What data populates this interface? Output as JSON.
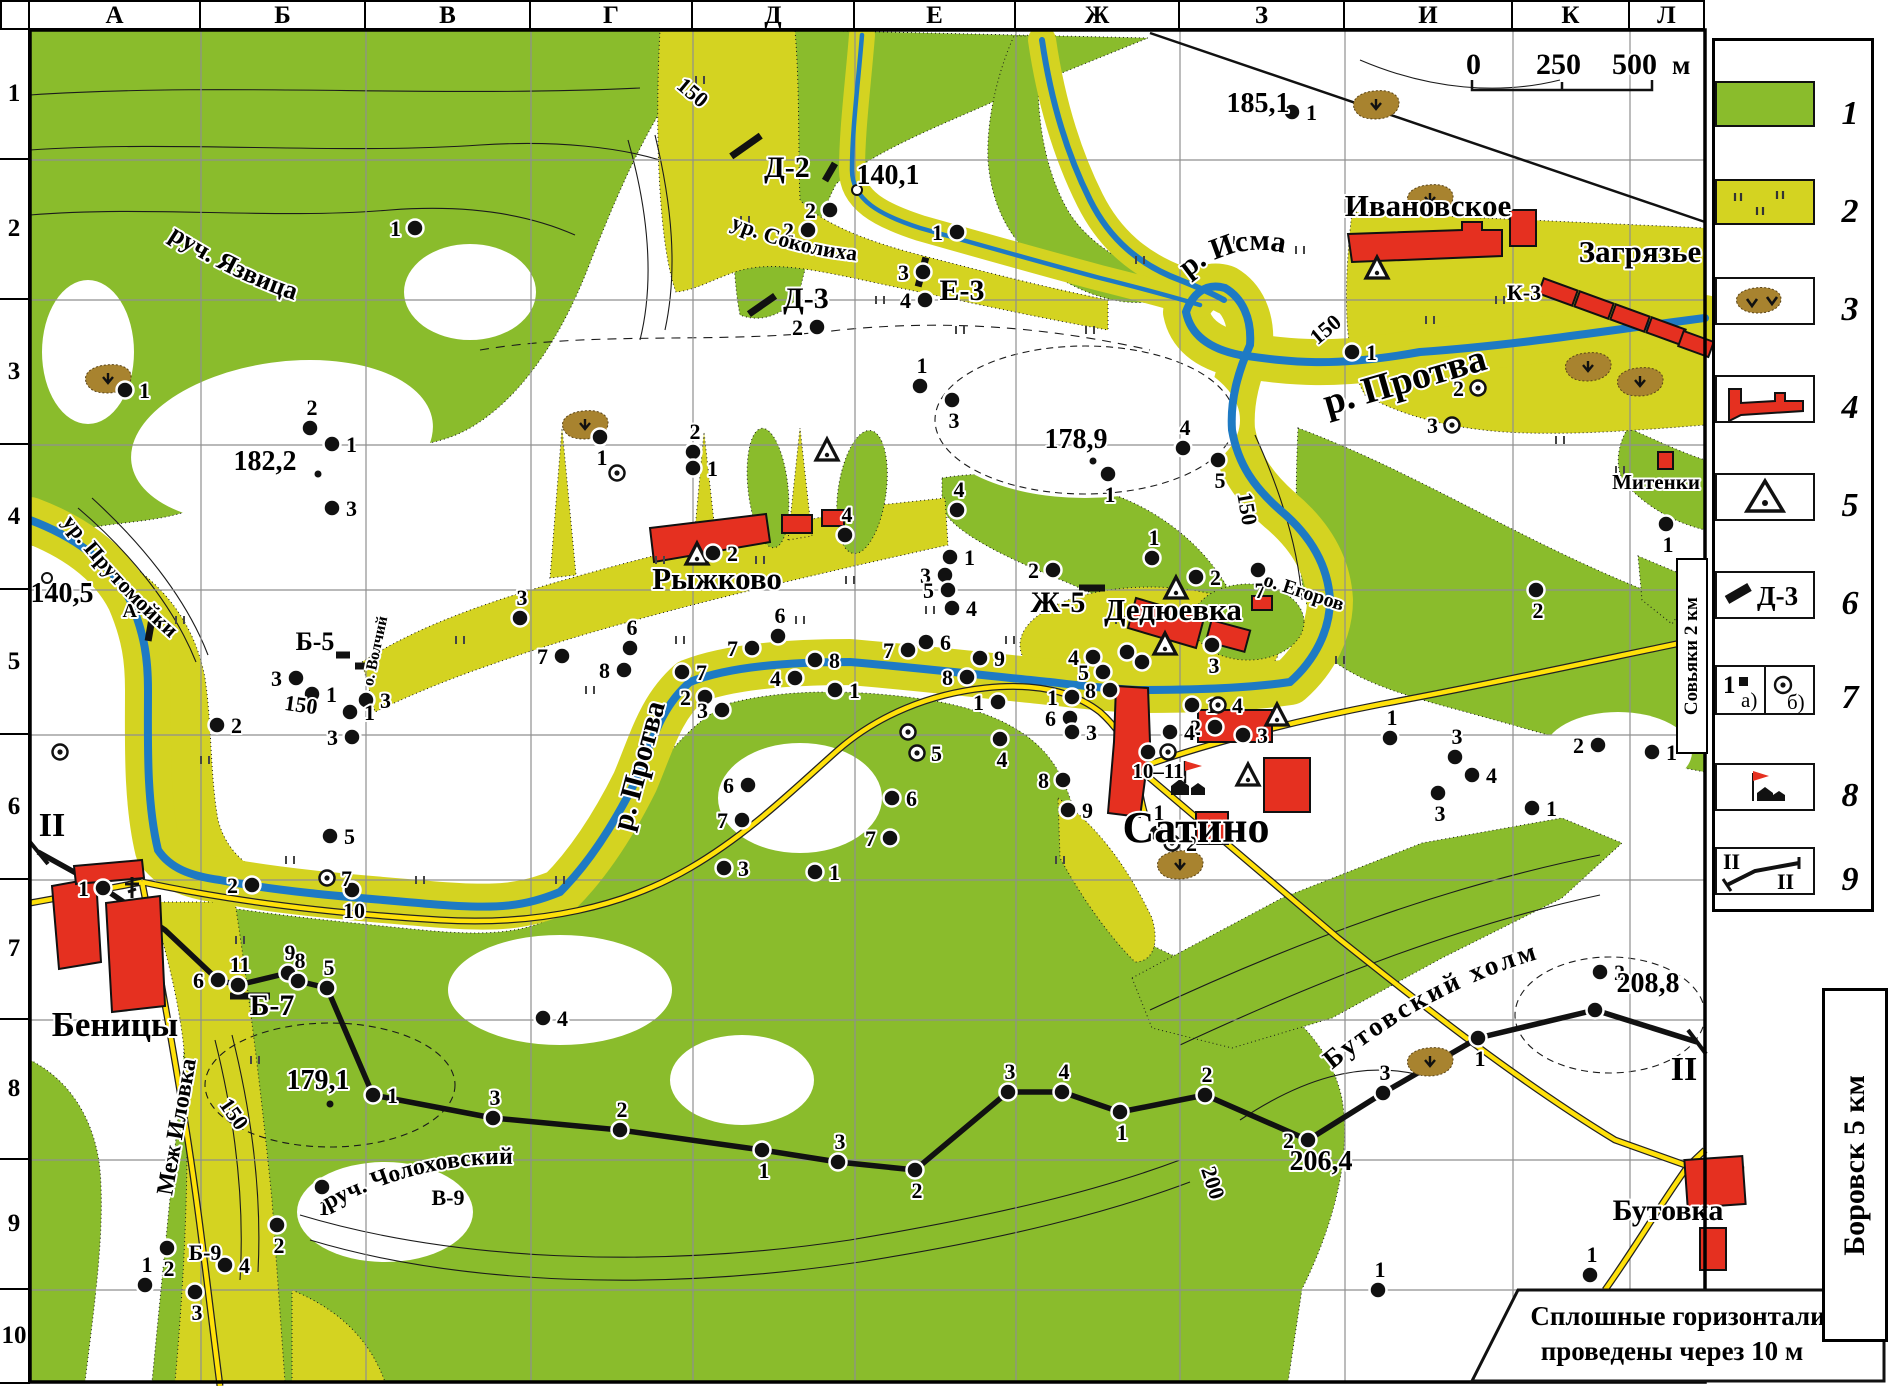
{
  "grid": {
    "columns": [
      "А",
      "Б",
      "В",
      "Г",
      "Д",
      "Е",
      "Ж",
      "З",
      "И",
      "К",
      "Л"
    ],
    "rows": [
      "1",
      "2",
      "3",
      "4",
      "5",
      "6",
      "7",
      "8",
      "9",
      "10"
    ]
  },
  "scalebar": {
    "t0": "0",
    "t1": "250",
    "t2": "500",
    "unit": "м"
  },
  "note": {
    "l1": "Сплошные  горизонтали",
    "l2": "проведены  через  10 м"
  },
  "edge": {
    "sovyaki": "Совьяки  2 км",
    "borovsk": "Боровск  5 км"
  },
  "legend": {
    "nums": [
      "1",
      "2",
      "3",
      "4",
      "5",
      "6",
      "7",
      "8",
      "9"
    ],
    "d3": "Д-3",
    "a": "а)",
    "b": "б)",
    "one": "1",
    "ii": "II"
  },
  "colors": {
    "forest": "#8abc2c",
    "meadow": "#d4d321",
    "water": "#1e7ac4",
    "road": "#ffe10a",
    "settlement": "#e53020",
    "pit": "#a8832f"
  },
  "map": {
    "settlements": [
      [
        "Ивановское",
        1428,
        216,
        31
      ],
      [
        "Загрязье",
        1640,
        262,
        31
      ],
      [
        "Митенки",
        1656,
        489,
        21
      ],
      [
        "Рыжково",
        717,
        589,
        31
      ],
      [
        "Дедюевка",
        1173,
        620,
        31
      ],
      [
        "Сатино",
        1196,
        842,
        44
      ],
      [
        "Беницы",
        115,
        1036,
        35
      ],
      [
        "Бутовка",
        1668,
        1220,
        30
      ]
    ],
    "elevations": [
      [
        "185,1",
        1258,
        112
      ],
      [
        "140,1",
        888,
        184
      ],
      [
        "182,2",
        265,
        470
      ],
      [
        "178,9",
        1076,
        448
      ],
      [
        "140,5",
        62,
        602
      ],
      [
        "179,1",
        318,
        1089
      ],
      [
        "208,8",
        1648,
        992
      ],
      [
        "206,4",
        1321,
        1170
      ]
    ],
    "contours": [
      [
        "150",
        688,
        98,
        40
      ],
      [
        "150",
        1330,
        335,
        -40
      ],
      [
        "150",
        1240,
        510,
        80
      ],
      [
        "150",
        300,
        712,
        8
      ],
      [
        "150",
        228,
        1118,
        55
      ],
      [
        "200",
        1206,
        1185,
        72
      ]
    ],
    "codes": [
      [
        "Д-2",
        787,
        177,
        30
      ],
      [
        "Д-3",
        806,
        308,
        30
      ],
      [
        "Е-3",
        962,
        300,
        30
      ],
      [
        "К-3",
        1524,
        300,
        22
      ],
      [
        "А-5",
        138,
        617,
        20
      ],
      [
        "Б-5",
        315,
        650,
        26
      ],
      [
        "Ж-5",
        1058,
        612,
        30
      ],
      [
        "Б-7",
        272,
        1015,
        30
      ],
      [
        "Б-9",
        205,
        1260,
        22
      ],
      [
        "В-9",
        448,
        1205,
        22
      ]
    ],
    "arcs": {
      "yazvitsa": "руч. Язвица",
      "sokoliha": "ур. Соколиха",
      "isma": "р. Исма",
      "prutomoyki": "ур. Прутомойки",
      "cholohovsky": "руч. Чолоховский",
      "butovsky": "Бутовский  холм"
    },
    "waters": [
      [
        "р. Протва",
        648,
        768,
        -75,
        30
      ],
      [
        "р. Протва",
        1408,
        392,
        -16,
        38
      ],
      [
        "о. Волчий",
        380,
        652,
        -78,
        16
      ],
      [
        "о. Егоров",
        1302,
        598,
        18,
        20
      ],
      [
        "Меж Иловка",
        184,
        1128,
        -80,
        24
      ]
    ],
    "plain": [
      [
        "10–11",
        1158,
        778,
        21
      ]
    ],
    "dots": [
      [
        415,
        228,
        "1",
        "l"
      ],
      [
        830,
        210,
        "2",
        "l"
      ],
      [
        808,
        230,
        "2",
        "l"
      ],
      [
        957,
        232,
        "1",
        "l"
      ],
      [
        923,
        272,
        "3",
        "l"
      ],
      [
        925,
        300,
        "4",
        "l"
      ],
      [
        817,
        327,
        "2",
        "l"
      ],
      [
        1292,
        112,
        "1",
        "r"
      ],
      [
        125,
        390,
        "1",
        "r"
      ],
      [
        310,
        428,
        "2",
        "a"
      ],
      [
        332,
        444,
        "1",
        "r"
      ],
      [
        332,
        508,
        "3",
        "r"
      ],
      [
        1352,
        352,
        "1",
        "r"
      ],
      [
        1666,
        524,
        "1",
        "b"
      ],
      [
        600,
        437,
        "1",
        "b"
      ],
      [
        693,
        452,
        "2",
        "a"
      ],
      [
        693,
        468,
        "1",
        "r"
      ],
      [
        920,
        386,
        "1",
        "a"
      ],
      [
        952,
        400,
        "3",
        "b"
      ],
      [
        957,
        510,
        "4",
        "a"
      ],
      [
        1183,
        448,
        "4",
        "a"
      ],
      [
        1218,
        460,
        "5",
        "b"
      ],
      [
        1108,
        474,
        "1",
        "b"
      ],
      [
        713,
        553,
        "2",
        "r"
      ],
      [
        845,
        535,
        "4",
        "a"
      ],
      [
        950,
        557,
        "1",
        "r"
      ],
      [
        945,
        575,
        "3",
        "l"
      ],
      [
        948,
        590,
        "5",
        "l"
      ],
      [
        952,
        608,
        "4",
        "r"
      ],
      [
        1053,
        570,
        "2",
        "l"
      ],
      [
        1152,
        558,
        "1",
        "a"
      ],
      [
        1196,
        577,
        "2",
        "r"
      ],
      [
        1212,
        645,
        "3",
        "b"
      ],
      [
        1258,
        570,
        "7",
        "b"
      ],
      [
        1536,
        590,
        "2",
        "b"
      ],
      [
        296,
        678,
        "3",
        "l"
      ],
      [
        312,
        694,
        "1",
        "r"
      ],
      [
        366,
        700,
        "3",
        "r"
      ],
      [
        520,
        618,
        "3",
        "a"
      ],
      [
        562,
        656,
        "7",
        "l"
      ],
      [
        630,
        648,
        "6",
        "a"
      ],
      [
        624,
        670,
        "8",
        "l"
      ],
      [
        682,
        672,
        "7",
        "r"
      ],
      [
        752,
        648,
        "7",
        "l"
      ],
      [
        778,
        636,
        "6",
        "a"
      ],
      [
        815,
        660,
        "8",
        "r"
      ],
      [
        795,
        678,
        "4",
        "l"
      ],
      [
        835,
        690,
        "1",
        "r"
      ],
      [
        705,
        697,
        "2",
        "l"
      ],
      [
        722,
        710,
        "3",
        "l"
      ],
      [
        748,
        785,
        "6",
        "l"
      ],
      [
        742,
        820,
        "7",
        "l"
      ],
      [
        724,
        868,
        "3",
        "r"
      ],
      [
        815,
        872,
        "1",
        "r"
      ],
      [
        908,
        650,
        "7",
        "l"
      ],
      [
        926,
        642,
        "6",
        "r"
      ],
      [
        980,
        658,
        "9",
        "r"
      ],
      [
        967,
        677,
        "8",
        "l"
      ],
      [
        892,
        798,
        "6",
        "r"
      ],
      [
        890,
        838,
        "7",
        "l"
      ],
      [
        1093,
        657,
        "4",
        "l"
      ],
      [
        1103,
        672,
        "5",
        "l"
      ],
      [
        1110,
        690,
        "8",
        "l"
      ],
      [
        1127,
        652,
        "",
        ""
      ],
      [
        1142,
        662,
        "",
        ""
      ],
      [
        998,
        702,
        "1",
        "l"
      ],
      [
        1072,
        697,
        "1",
        "l"
      ],
      [
        1070,
        718,
        "6",
        "l"
      ],
      [
        1072,
        732,
        "3",
        "r"
      ],
      [
        1000,
        739,
        "4",
        "b"
      ],
      [
        1063,
        780,
        "8",
        "l"
      ],
      [
        1068,
        810,
        "9",
        "r"
      ],
      [
        1148,
        752,
        "",
        ""
      ],
      [
        1192,
        705,
        "1",
        "r"
      ],
      [
        1215,
        727,
        "2",
        "l"
      ],
      [
        1243,
        735,
        "3",
        "r"
      ],
      [
        1170,
        732,
        "4",
        "r"
      ],
      [
        1390,
        738,
        "1",
        "a"
      ],
      [
        1455,
        757,
        "3",
        "a"
      ],
      [
        1472,
        775,
        "4",
        "r"
      ],
      [
        1438,
        793,
        "3",
        "b"
      ],
      [
        1532,
        808,
        "1",
        "r"
      ],
      [
        1598,
        745,
        "2",
        "l"
      ],
      [
        1652,
        752,
        "1",
        "r"
      ],
      [
        103,
        888,
        "1",
        "l"
      ],
      [
        252,
        885,
        "2",
        "l"
      ],
      [
        330,
        836,
        "5",
        "r"
      ],
      [
        352,
        890,
        "10",
        "b"
      ],
      [
        217,
        725,
        "2",
        "r"
      ],
      [
        350,
        712,
        "1",
        "r"
      ],
      [
        352,
        737,
        "3",
        "l"
      ],
      [
        218,
        980,
        "6",
        "l"
      ],
      [
        238,
        985,
        "11",
        "a"
      ],
      [
        288,
        973,
        "9",
        "a"
      ],
      [
        298,
        981,
        "8",
        "a"
      ],
      [
        327,
        988,
        "5",
        "a"
      ],
      [
        543,
        1018,
        "4",
        "r"
      ],
      [
        1157,
        833,
        "1",
        "a"
      ],
      [
        1600,
        972,
        "2",
        "r"
      ],
      [
        373,
        1095,
        "1",
        "r"
      ],
      [
        493,
        1118,
        "3",
        "a"
      ],
      [
        620,
        1130,
        "2",
        "a"
      ],
      [
        762,
        1150,
        "1",
        "b"
      ],
      [
        838,
        1162,
        "3",
        "a"
      ],
      [
        915,
        1170,
        "2",
        "b"
      ],
      [
        1008,
        1092,
        "3",
        "a"
      ],
      [
        1062,
        1092,
        "4",
        "a"
      ],
      [
        1120,
        1112,
        "1",
        "b"
      ],
      [
        1205,
        1095,
        "2",
        "a"
      ],
      [
        1308,
        1140,
        "2",
        "l"
      ],
      [
        1383,
        1093,
        "3",
        "a"
      ],
      [
        1478,
        1038,
        "1",
        "b"
      ],
      [
        1595,
        1010,
        "",
        ""
      ],
      [
        167,
        1248,
        "2",
        "b"
      ],
      [
        145,
        1285,
        "1",
        "a"
      ],
      [
        195,
        1292,
        "3",
        "b"
      ],
      [
        225,
        1265,
        "4",
        "r"
      ],
      [
        277,
        1225,
        "2",
        "b"
      ],
      [
        322,
        1187,
        "1",
        "b"
      ],
      [
        1378,
        1290,
        "1",
        "a"
      ],
      [
        1590,
        1275,
        "1",
        "a"
      ]
    ],
    "odots": [
      [
        617,
        473,
        "",
        ""
      ],
      [
        1478,
        388,
        "2",
        "l"
      ],
      [
        1452,
        425,
        "3",
        "l"
      ],
      [
        908,
        732,
        "",
        ""
      ],
      [
        917,
        753,
        "5",
        "r"
      ],
      [
        327,
        878,
        "7",
        "r"
      ],
      [
        1218,
        705,
        "4",
        "r"
      ],
      [
        1168,
        752,
        "",
        ""
      ],
      [
        1172,
        843,
        "2",
        "r"
      ],
      [
        60,
        752,
        "",
        ""
      ]
    ],
    "hollow": [
      [
        857,
        190
      ],
      [
        47,
        578
      ]
    ],
    "smalls": [
      [
        318,
        474
      ],
      [
        1093,
        461
      ],
      [
        330,
        1104
      ]
    ],
    "tri": [
      [
        1377,
        270
      ],
      [
        827,
        452
      ],
      [
        697,
        556
      ],
      [
        1176,
        590
      ],
      [
        1165,
        646
      ],
      [
        1277,
        717
      ],
      [
        1248,
        777
      ]
    ],
    "pits": [
      [
        108,
        382
      ],
      [
        585,
        428
      ],
      [
        1376,
        108
      ],
      [
        1430,
        202
      ],
      [
        1588,
        370
      ],
      [
        1640,
        385
      ],
      [
        1180,
        868
      ],
      [
        1430,
        1065
      ]
    ],
    "bars": [
      [
        746,
        146,
        -35,
        36
      ],
      [
        830,
        172,
        -60,
        20
      ],
      [
        762,
        305,
        -35,
        32
      ],
      [
        922,
        272,
        -75,
        30
      ],
      [
        150,
        630,
        -80,
        22
      ],
      [
        343,
        655,
        0,
        14
      ],
      [
        362,
        666,
        0,
        14
      ],
      [
        1092,
        588,
        0,
        26
      ],
      [
        250,
        996,
        0,
        40
      ]
    ],
    "marks": [
      [
        700,
        80
      ],
      [
        745,
        220
      ],
      [
        880,
        300
      ],
      [
        960,
        330
      ],
      [
        1090,
        330
      ],
      [
        1140,
        260
      ],
      [
        1230,
        240
      ],
      [
        1300,
        250
      ],
      [
        1430,
        320
      ],
      [
        1500,
        300
      ],
      [
        1560,
        440
      ],
      [
        1620,
        470
      ],
      [
        180,
        620
      ],
      [
        205,
        760
      ],
      [
        290,
        860
      ],
      [
        420,
        880
      ],
      [
        560,
        880
      ],
      [
        680,
        640
      ],
      [
        800,
        620
      ],
      [
        930,
        610
      ],
      [
        1010,
        640
      ],
      [
        1120,
        620
      ],
      [
        240,
        940
      ],
      [
        255,
        1060
      ],
      [
        590,
        690
      ],
      [
        660,
        560
      ],
      [
        760,
        560
      ],
      [
        850,
        580
      ],
      [
        460,
        640
      ],
      [
        1060,
        860
      ],
      [
        1340,
        660
      ]
    ],
    "profile": {
      "pts": [
        [
          38,
          852
        ],
        [
          103,
          888
        ],
        [
          165,
          930
        ],
        [
          218,
          980
        ],
        [
          238,
          985
        ],
        [
          288,
          973
        ],
        [
          298,
          981
        ],
        [
          327,
          988
        ],
        [
          373,
          1095
        ],
        [
          493,
          1118
        ],
        [
          620,
          1130
        ],
        [
          762,
          1150
        ],
        [
          838,
          1162
        ],
        [
          915,
          1170
        ],
        [
          1008,
          1092
        ],
        [
          1062,
          1092
        ],
        [
          1120,
          1112
        ],
        [
          1205,
          1095
        ],
        [
          1308,
          1140
        ],
        [
          1383,
          1093
        ],
        [
          1478,
          1038
        ],
        [
          1595,
          1010
        ],
        [
          1697,
          1042
        ]
      ],
      "label": "II",
      "lbl1": [
        52,
        836
      ],
      "lbl2": [
        1684,
        1080
      ]
    },
    "camp": [
      1185,
      795
    ],
    "church": [
      132,
      895
    ]
  }
}
